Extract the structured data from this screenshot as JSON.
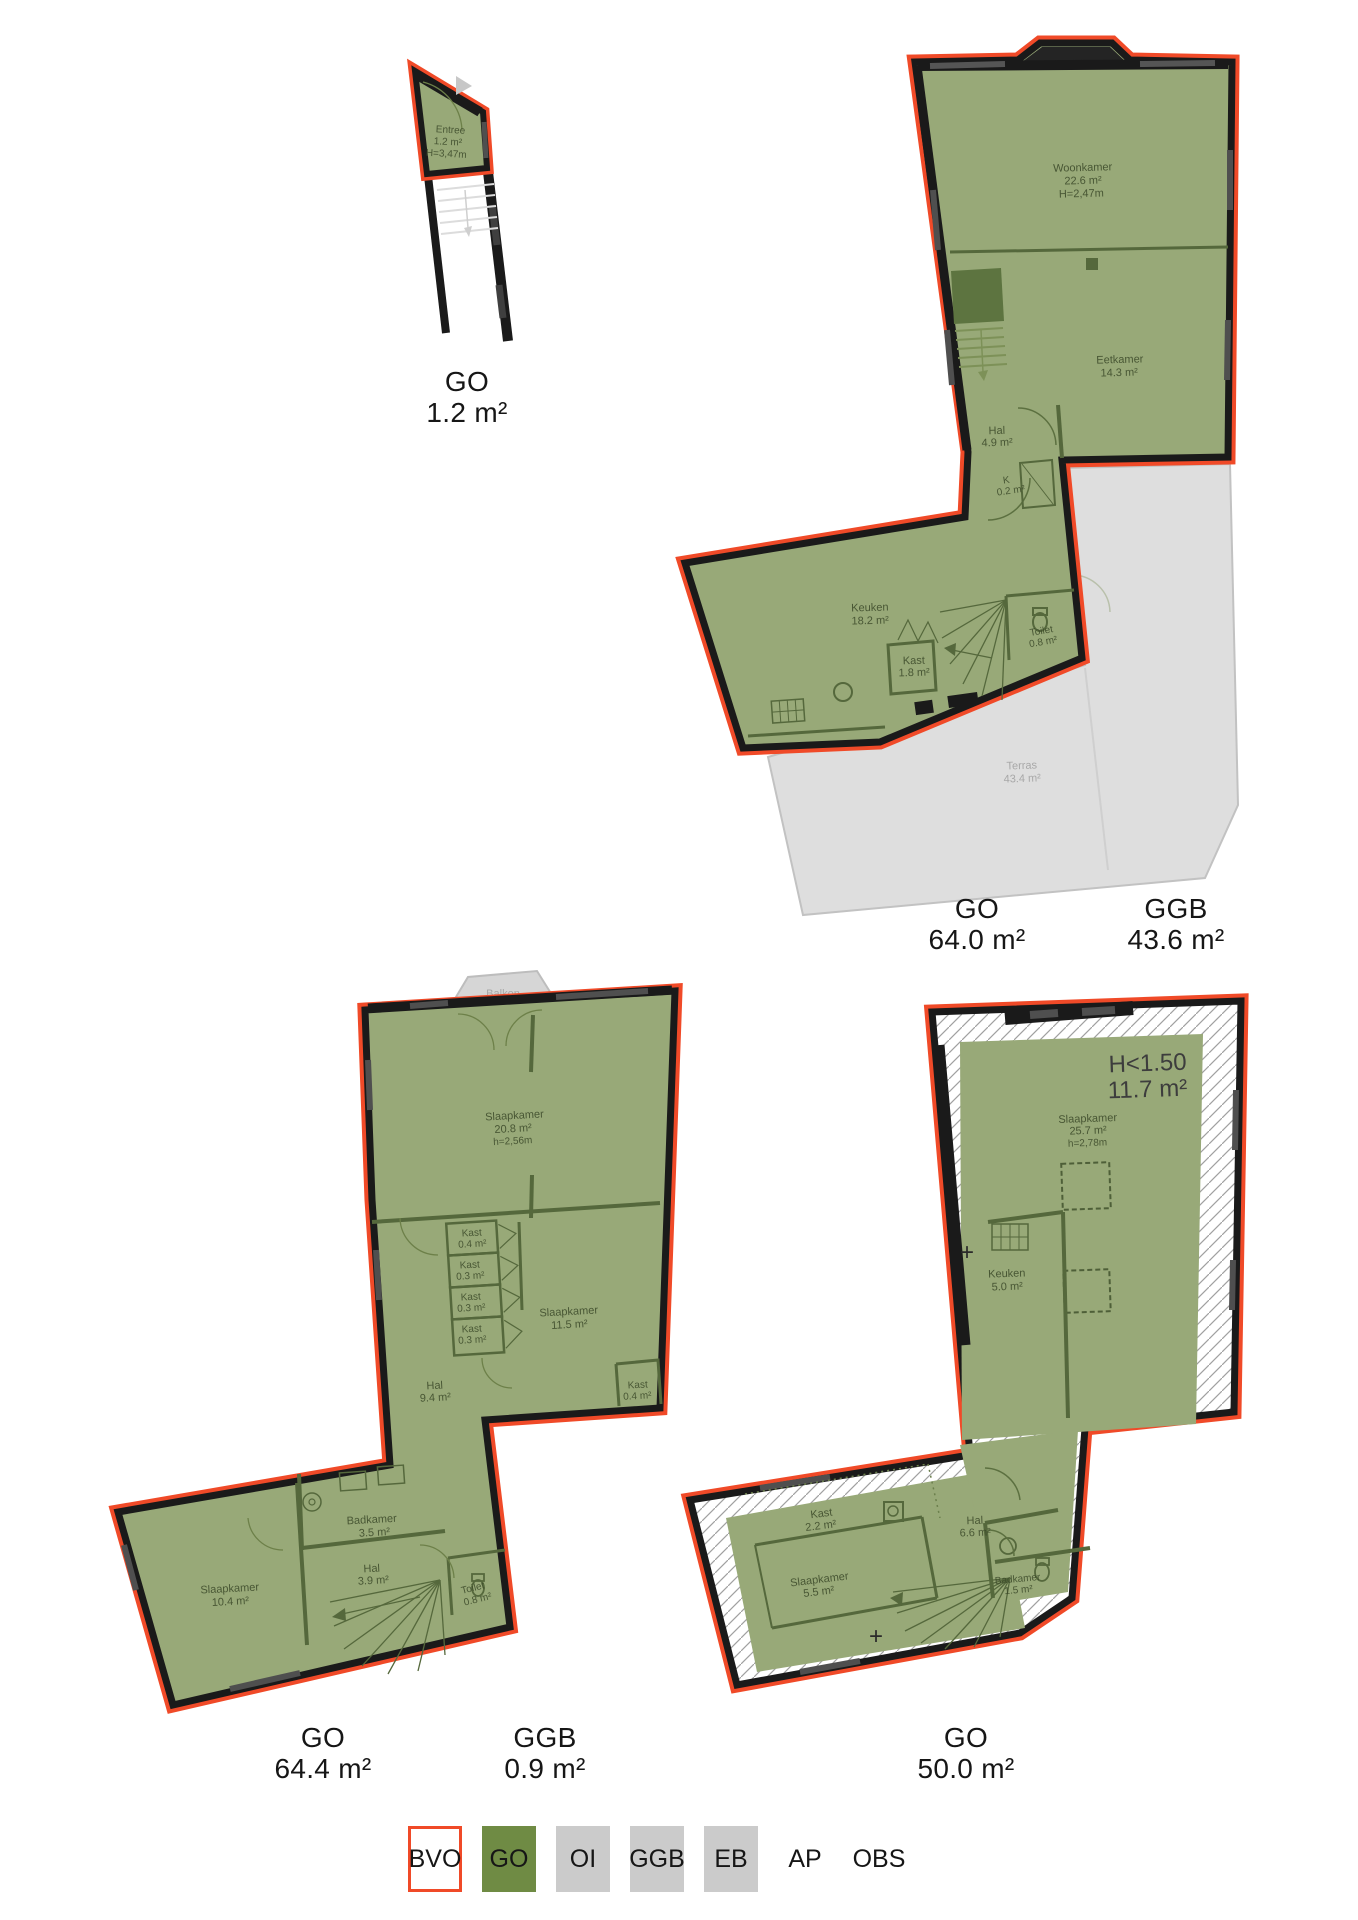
{
  "colors": {
    "bvo_outline_red": "#f04a28",
    "go_green": "#6f8b44",
    "surface_grey": "#cbcbcb",
    "wall_black": "#1a1a1a"
  },
  "plans": {
    "p1": {
      "rooms": {
        "entree": {
          "name": "Entree",
          "area": "1.2 m²",
          "height": "H=3,47m"
        }
      },
      "totals": [
        {
          "label": "GO",
          "value": "1.2 m²"
        }
      ]
    },
    "p2": {
      "rooms": {
        "woonkamer": {
          "name": "Woonkamer",
          "area": "22.6 m²",
          "height": "H=2,47m"
        },
        "eetkamer": {
          "name": "Eetkamer",
          "area": "14.3 m²"
        },
        "hal": {
          "name": "Hal",
          "area": "4.9 m²"
        },
        "k": {
          "name": "K",
          "area": "0.2 m²"
        },
        "keuken": {
          "name": "Keuken",
          "area": "18.2 m²"
        },
        "kast": {
          "name": "Kast",
          "area": "1.8 m²"
        },
        "toilet": {
          "name": "Toilet",
          "area": "0.8 m²"
        },
        "terras": {
          "name": "Terras",
          "area": "43.4 m²"
        }
      },
      "totals": [
        {
          "label": "GO",
          "value": "64.0 m²"
        },
        {
          "label": "GGB",
          "value": "43.6 m²"
        }
      ]
    },
    "p3": {
      "rooms": {
        "balkon": {
          "name": "Balkon",
          "area": "0.9 m²"
        },
        "slaapkamer1": {
          "name": "Slaapkamer",
          "area": "20.8 m²",
          "height": "h=2,56m"
        },
        "kast1": {
          "name": "Kast",
          "area": "0.4 m²"
        },
        "kast2": {
          "name": "Kast",
          "area": "0.3 m²"
        },
        "kast3": {
          "name": "Kast",
          "area": "0.3 m²"
        },
        "kast4": {
          "name": "Kast",
          "area": "0.3 m²"
        },
        "slaapkamer2": {
          "name": "Slaapkamer",
          "area": "11.5 m²"
        },
        "kast5": {
          "name": "Kast",
          "area": "0.4 m²"
        },
        "hal1": {
          "name": "Hal",
          "area": "9.4 m²"
        },
        "badkamer": {
          "name": "Badkamer",
          "area": "3.5 m²"
        },
        "hal2": {
          "name": "Hal",
          "area": "3.9 m²"
        },
        "slaapkamer3": {
          "name": "Slaapkamer",
          "area": "10.4 m²"
        },
        "toilet": {
          "name": "Toilet",
          "area": "0.8 m²"
        }
      },
      "totals": [
        {
          "label": "GO",
          "value": "64.4 m²"
        },
        {
          "label": "GGB",
          "value": "0.9 m²"
        }
      ]
    },
    "p4": {
      "low_height": {
        "line1": "H<1.50",
        "line2": "11.7 m²"
      },
      "markers": {
        "plus": "+"
      },
      "rooms": {
        "slaapkamer1": {
          "name": "Slaapkamer",
          "area": "25.7 m²",
          "height": "h=2,78m"
        },
        "keuken": {
          "name": "Keuken",
          "area": "5.0 m²"
        },
        "kast": {
          "name": "Kast",
          "area": "2.2 m²"
        },
        "hal": {
          "name": "Hal",
          "area": "6.6 m²"
        },
        "slaapkamer2": {
          "name": "Slaapkamer",
          "area": "5.5 m²"
        },
        "badkamer": {
          "name": "Badkamer",
          "area": "1.5 m²"
        }
      },
      "totals": [
        {
          "label": "GO",
          "value": "50.0 m²"
        }
      ]
    }
  },
  "legend": {
    "items": [
      {
        "label": "BVO"
      },
      {
        "label": "GO"
      },
      {
        "label": "OI"
      },
      {
        "label": "GGB"
      },
      {
        "label": "EB"
      },
      {
        "label": "AP"
      },
      {
        "label": "OBS"
      }
    ]
  }
}
